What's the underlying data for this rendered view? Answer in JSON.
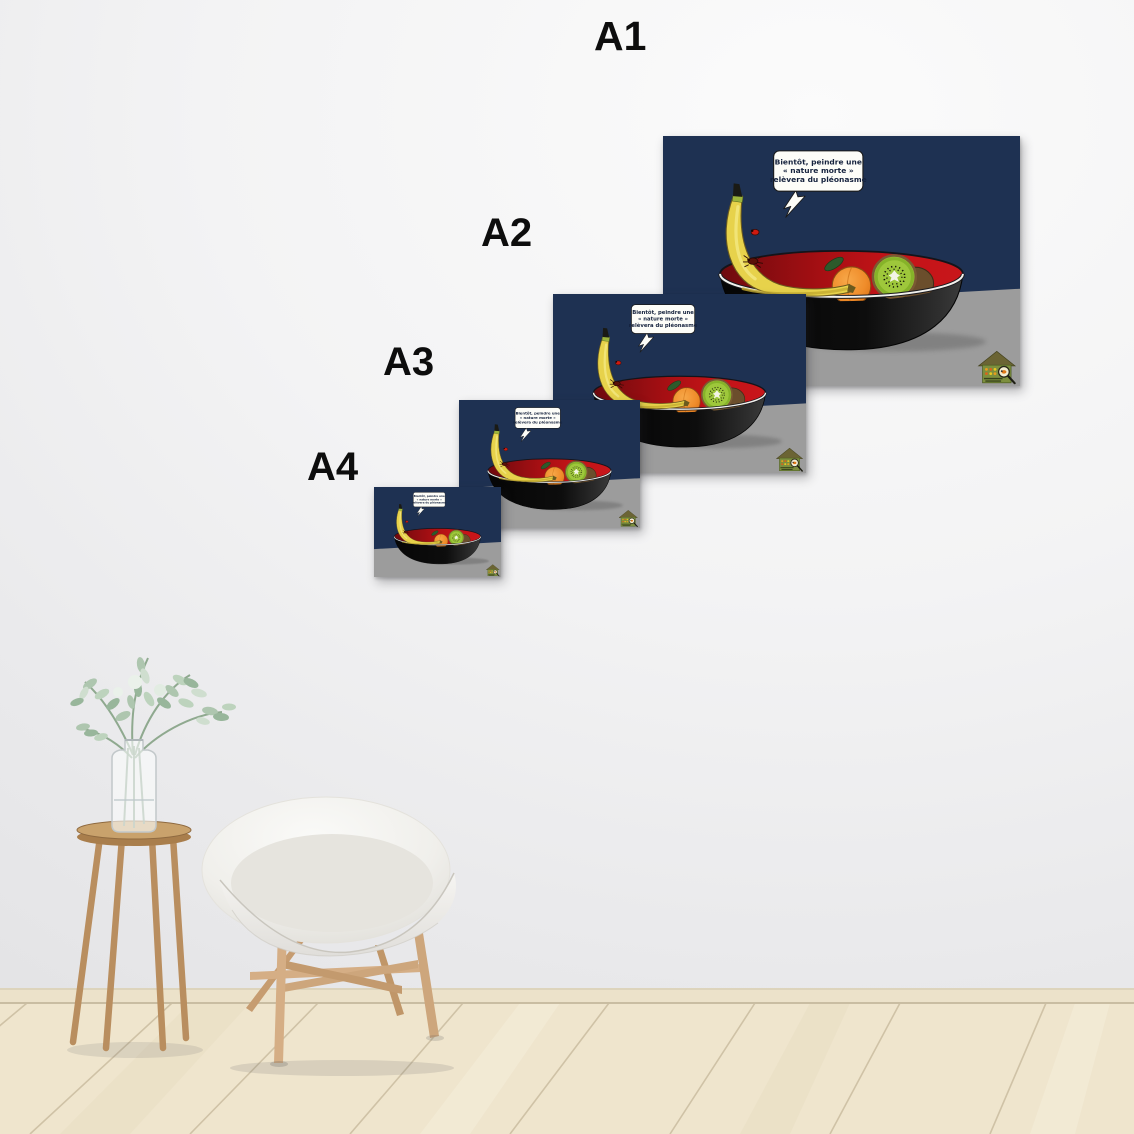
{
  "scene": {
    "description": "Poster size comparison mockup (A1 to A4) on a wall above a wooden floor with an armchair and a plant stool",
    "wall_color": "#f1f1f2",
    "floor_color": "#efe5cd"
  },
  "size_labels": [
    {
      "id": "a1",
      "label": "A1"
    },
    {
      "id": "a2",
      "label": "A2"
    },
    {
      "id": "a3",
      "label": "A3"
    },
    {
      "id": "a4",
      "label": "A4"
    }
  ],
  "poster": {
    "speech_bubble": {
      "line1": "Bientôt, peindre une",
      "line2": "« nature morte »",
      "line3": "relèvera du pléonasme"
    },
    "logo": "insect-hotel-logo",
    "colors": {
      "background_navy": "#1e3152",
      "bowl_red": "#c41318",
      "bowl_black": "#0d0d0d",
      "table_gray": "#9c9c9c",
      "banana_yellow": "#e7d24b",
      "kiwi_green": "#9ec73b",
      "orange": "#ef8c2a"
    }
  }
}
